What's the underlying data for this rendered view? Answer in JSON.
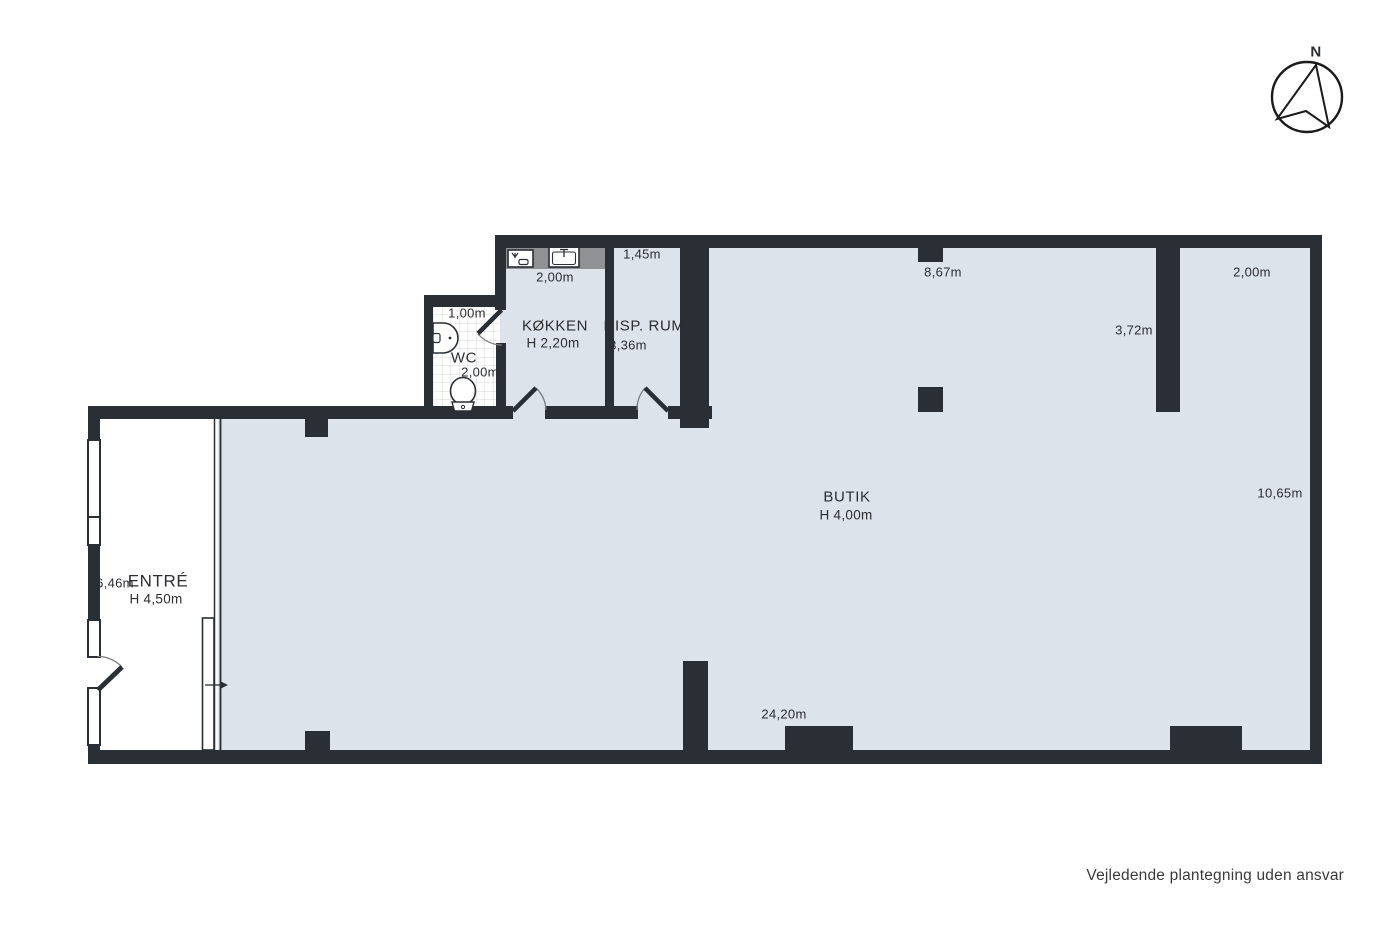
{
  "colors": {
    "wall": "#2a2f36",
    "floor": "#dde3eb",
    "counter": "#909194",
    "tile": "#d9d9d9",
    "text": "#2b2d30"
  },
  "compass": {
    "label": "N"
  },
  "rooms": {
    "entre": {
      "name": "ENTRÉ",
      "ceiling": "H 4,50m",
      "width": "6,46m"
    },
    "butik": {
      "name": "BUTIK",
      "ceiling": "H 4,00m",
      "dims": {
        "top": "8,67m",
        "top_right": "2,00m",
        "inner_wall": "3,72m",
        "right": "10,65m",
        "bottom": "24,20m"
      }
    },
    "kokken": {
      "name": "KØKKEN",
      "ceiling": "H 2,20m",
      "width": "2,00m"
    },
    "wc": {
      "name": "WC",
      "width": "1,00m",
      "depth": "2,00m"
    },
    "disp_rum": {
      "name": "DISP. RUM",
      "width": "1,45m",
      "depth": "3,36m"
    }
  },
  "footer": {
    "disclaimer": "Vejledende plantegning uden ansvar"
  }
}
